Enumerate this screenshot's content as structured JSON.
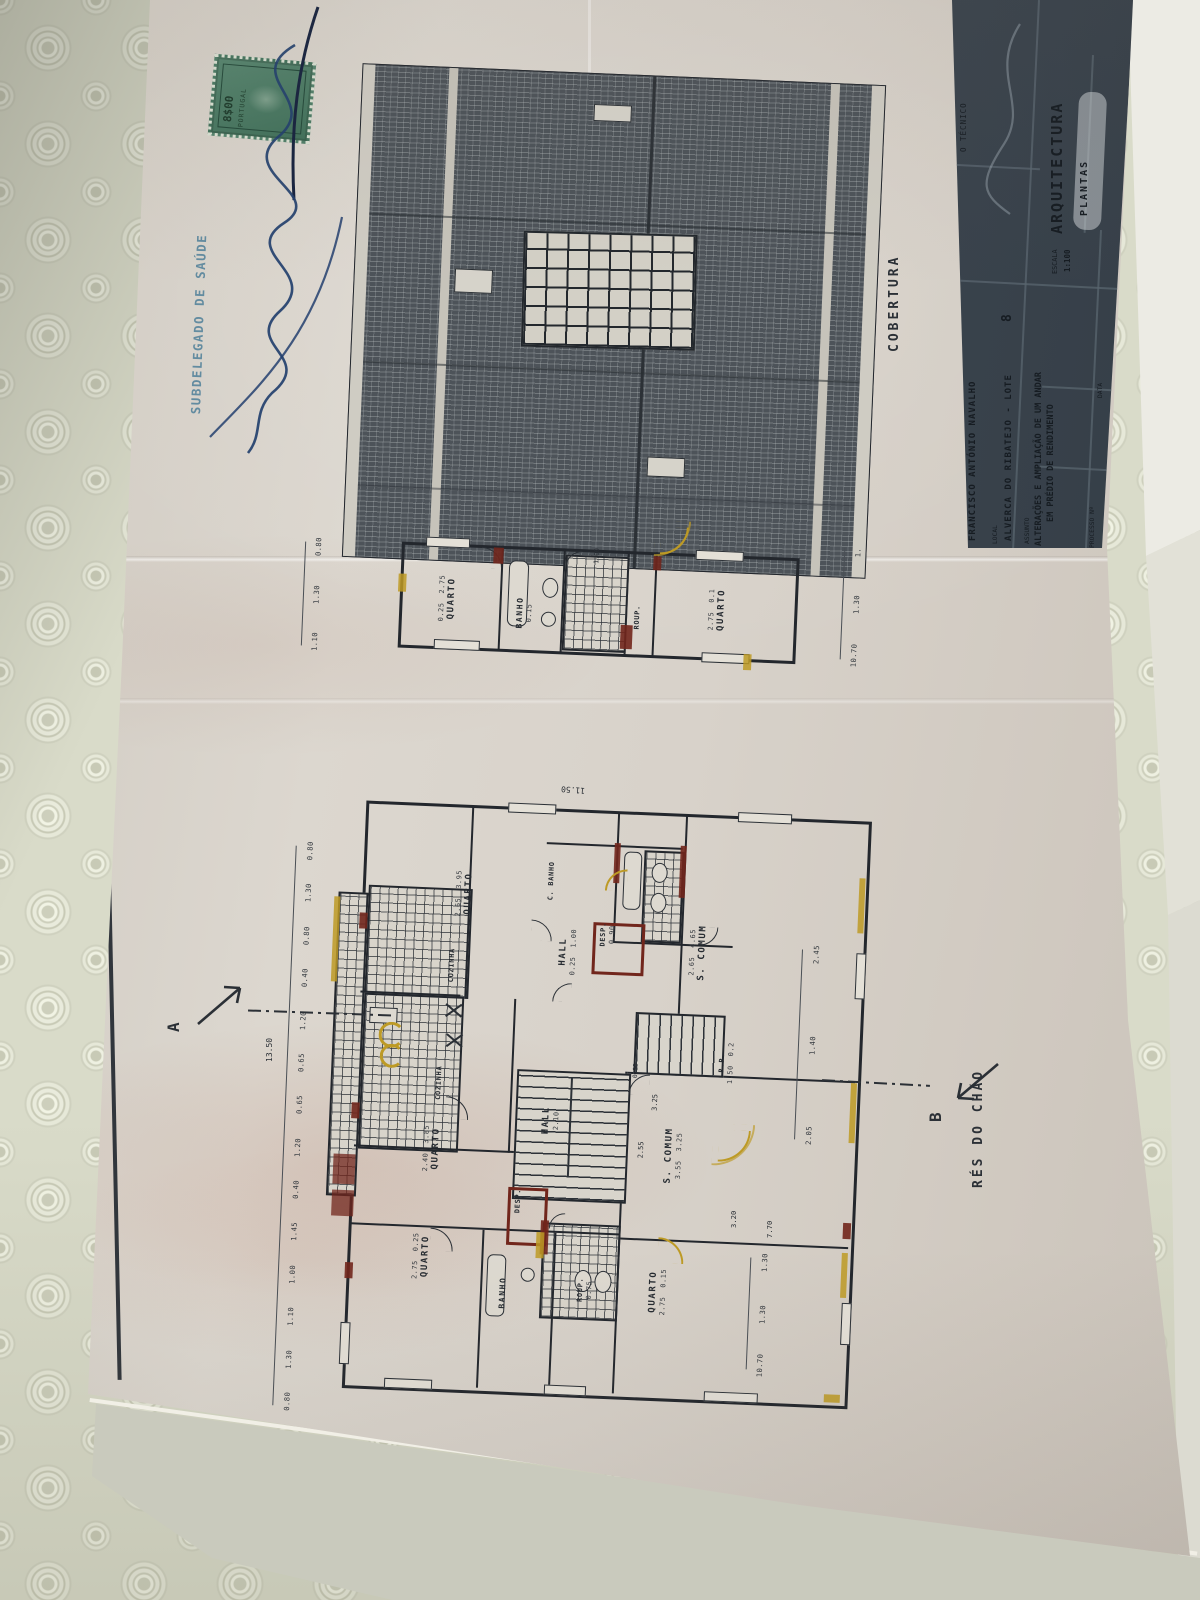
{
  "colors": {
    "paper": "#d8d2ca",
    "ink": "#2b3036",
    "titleblock_bg": "#3a434d",
    "alteration_yellow": "#bd9a25",
    "alteration_red": "#71261c",
    "fiscal_stamp_green": "#4b7a64",
    "health_stamp_blue": "#4f7f99",
    "signature_blue": "#23406e",
    "tablecloth": "#d9dbc9"
  },
  "stamps": {
    "health_office": "SUBDELEGADO DE SAÚDE",
    "fiscal_value": "8$00",
    "fiscal_country": "PORTUGAL"
  },
  "roof_plan": {
    "label": "COBERTURA"
  },
  "upper_plan": {
    "rooms": [
      {
        "name": "QUARTO",
        "d1": "2.75",
        "d2": "0.25"
      },
      {
        "name": "BANHO",
        "d1": "0.15"
      },
      {
        "name": "ROUP."
      },
      {
        "name": "QUARTO",
        "d1": "2.75",
        "d2": "0.1"
      }
    ],
    "extra_dim": "1.00",
    "dims_left": [
      "0.80",
      "1.30",
      "1.10"
    ],
    "dims_right": [
      "1.",
      "1.30",
      "10.70"
    ]
  },
  "main_plan": {
    "floor_label": "RÉS DO CHÃO",
    "section_marker_a": "A",
    "section_marker_b": "B",
    "overall_width": "11.50",
    "overall_height": "13.50",
    "dim_7_70": "7.70",
    "dim_3_20": "3.20",
    "stairs": {
      "d1": "2.55",
      "d2": "3.25",
      "d3": "0.25"
    },
    "rooms": [
      {
        "name": "QUARTO",
        "d1": "3.95",
        "d2": "2.65"
      },
      {
        "name": "C. BANHO"
      },
      {
        "name": "DESP.",
        "d1": "0.90"
      },
      {
        "name": "S. COMUM",
        "d1": "4.65",
        "d2": "2.65"
      },
      {
        "name": "COZINHA"
      },
      {
        "name": "HALL",
        "d1": "1.00",
        "d2": "0.25"
      },
      {
        "name": "COZINHA"
      },
      {
        "name": "QUARTO",
        "d1": "3.85",
        "d2": "2.40"
      },
      {
        "name": "HALL",
        "d1": "2.10"
      },
      {
        "name": "S. COMUM",
        "d1": "3.55",
        "d2": "3.25"
      },
      {
        "name": "R.P.",
        "d1": "1.50",
        "d2": "0.2"
      },
      {
        "name": "DESP.",
        "d1": "0.15"
      },
      {
        "name": "BANHO"
      },
      {
        "name": "ROUP.",
        "d1": "0.75"
      },
      {
        "name": "QUARTO",
        "d1": "2.75",
        "d2": "0.25"
      },
      {
        "name": "QUARTO",
        "d1": "2.75",
        "d2": "0.15"
      }
    ],
    "dim_chain_top": [
      "0.80",
      "1.30",
      "0.80",
      "0.40",
      "1.20",
      "0.65",
      "0.65",
      "1.20",
      "0.40",
      "1.45",
      "1.00",
      "1.10",
      "1.30",
      "0.80"
    ],
    "dims_right": [
      "2.45",
      "1.40",
      "2.05"
    ],
    "dims_bottom_right": [
      "1.30",
      "1.30",
      "10.70"
    ]
  },
  "title_block": {
    "sheet_number": "2",
    "technician_label": "O TÉCNICO",
    "discipline": "ARQUITECTURA",
    "drawing_type": "PLANTAS",
    "escala_label": "ESCALA",
    "escala_value": "1:100",
    "requerente_label": "REQUERENTE",
    "requerente_value": "FRANCISCO ANTÓNIO NAVALHO",
    "local_label": "LOCAL",
    "local_value": "ALVERCA DO RIBATEJO - LOTE",
    "lote_number": "8",
    "assunto_label": "ASSUNTO",
    "assunto_line1": "ALTERAÇÕES E AMPLIAÇÃO DE UM ANDAR",
    "assunto_line2": "EM PRÉDIO DE RENDIMENTO",
    "processo_label": "PROCESSO Nº",
    "data_label": "DATA"
  }
}
